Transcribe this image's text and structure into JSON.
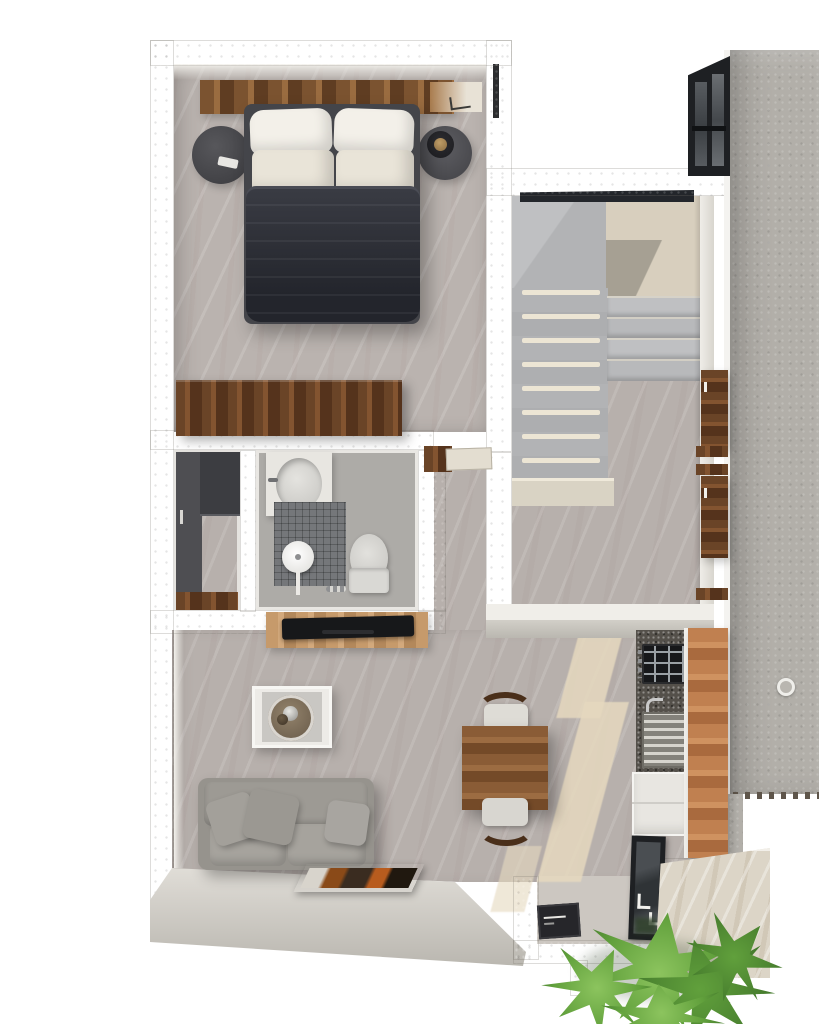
{
  "scene": {
    "kind": "3d-rendered-floor-plan",
    "view": "top-down",
    "description": "One-bedroom apartment render: bedroom top-left, U-shaped staircase hall top-right, closet and bathroom mid-left, living and dining below, kitchen strip on right, entry vestibule and planted patio at bottom, concrete slab along right edge"
  },
  "palette": {
    "bg": "#ffffff",
    "wallOuter": "#d2cfc8",
    "wallOuterDark": "#bab7b0",
    "wallInner": "#f3f1ec",
    "wallInnerWarm": "#efe9dd",
    "floorMain": "#b7b0ac",
    "floorBed": "#bab3af",
    "floorBright": "#ccc7c1",
    "landingBeige": "#d8cfbe",
    "stepGray": "#b2b3b5",
    "stepLight": "#bfc0c2",
    "nosing": "#ece5d4",
    "concrete": "#b2afa9",
    "duvet": "#2c2e36",
    "bedFrame": "#44454a",
    "pillow": "#f3f0e9",
    "pillowShade": "#e9e4d8",
    "nightstand": "#4c4c50",
    "lampGold": "#8a6c42",
    "sofa": "#96938d",
    "sofaCushion": "#a6a39d",
    "porcelain": "#d9d8d4",
    "whiteGoods": "#e8e6e1",
    "tile": "#75777a",
    "counterDark": "#54504a",
    "steel": "#b9b8b2",
    "stoveBlack": "#17181a",
    "frameBlack": "#1e2023",
    "glassDark": "#2f3336",
    "beam": "#e6d9bf",
    "plantLight": "#8cc45e",
    "plantMid": "#61a03c",
    "plantDark": "#3e7229",
    "patio": "#dcd5c7",
    "matDark": "#26262a",
    "skylight": "#23262b",
    "saw": "#5e554a"
  },
  "rooms": [
    {
      "id": "bedroom",
      "name": "bedroom",
      "furniture": [
        "double-bed",
        "dark-duvet",
        "four-white-pillows",
        "wood-headboard-panel",
        "round-nightstand-left",
        "round-nightstand-right",
        "table-lamp",
        "wood-dresser",
        "wall-window"
      ]
    },
    {
      "id": "stair-hall",
      "name": "staircase hall",
      "furniture": [
        "u-shaped-staircase",
        "upper-landing",
        "skylight-strip",
        "wall-mounted-wood-shelves",
        "wood-entry-threshold"
      ]
    },
    {
      "id": "closet",
      "name": "walk-in closet",
      "furniture": [
        "dark-wardrobe-unit",
        "wood-floor-threshold"
      ]
    },
    {
      "id": "bathroom",
      "name": "bathroom",
      "furniture": [
        "vanity-with-oval-sink",
        "walk-in-shower-tiled",
        "rain-shower-head",
        "toilet"
      ]
    },
    {
      "id": "living-room",
      "name": "living room",
      "furniture": [
        "gray-sofa",
        "three-throw-pillows",
        "white-side-table",
        "glass-tray-decor",
        "tv-console",
        "flat-tv",
        "framed-artwork"
      ]
    },
    {
      "id": "dining-area",
      "name": "dining area",
      "furniture": [
        "square-wood-table",
        "chair-north",
        "chair-south"
      ]
    },
    {
      "id": "kitchen",
      "name": "kitchen",
      "furniture": [
        "speckled-countertop",
        "gas-cooktop",
        "sink-with-drainboard",
        "white-base-cabinets",
        "tall-wood-cabinet"
      ]
    },
    {
      "id": "entry",
      "name": "entry vestibule",
      "furniture": [
        "dark-door-mat",
        "black-framed-glass-door"
      ]
    },
    {
      "id": "exterior",
      "name": "exterior",
      "furniture": [
        "concrete-slab",
        "floor-drain",
        "sawtooth-edge",
        "travertine-patio",
        "tropical-plants",
        "black-corner-window",
        "sunlight-beams"
      ]
    }
  ]
}
